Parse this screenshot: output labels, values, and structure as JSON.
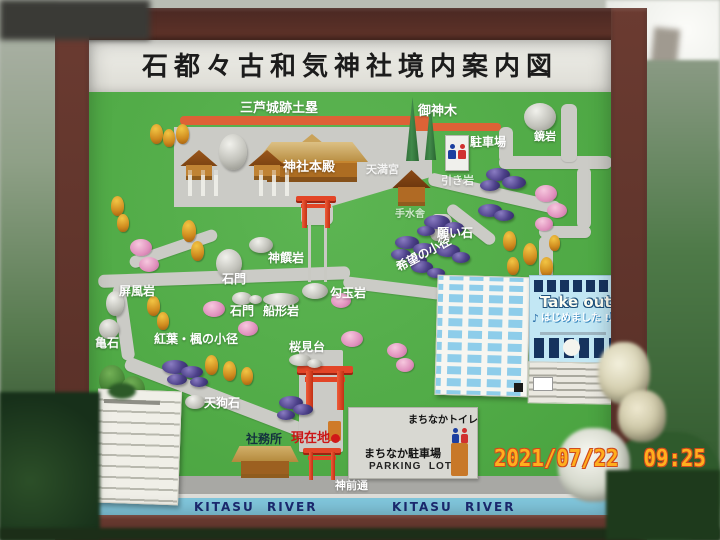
{
  "photo": {
    "timestamp": "2021/07/22  09:25"
  },
  "board": {
    "title": "石都々古和気神社境内案内図",
    "map": {
      "labels": {
        "dorui": "三芦城跡土塁",
        "goshinboku": "御神木",
        "parking": "駐車場",
        "kagamiiwa": "鏡岩",
        "honden": "神社本殿",
        "tenmangu": "天満宮",
        "hikiiwa": "引き岩",
        "temizuya": "手水舎",
        "negaiishi": "願い石",
        "kibou_no_komichi": "希望の小径",
        "shinseniwa": "神饌岩",
        "sekimon_upper": "石門",
        "sekimon_lower": "石門",
        "magatamaiwa": "勾玉岩",
        "funagataiwa": "船形岩",
        "byobuiwa": "屏風岩",
        "kameishi": "亀石",
        "momiji_no_komichi": "紅葉・楓の小径",
        "sakuramidai": "桜見台",
        "tenguseki": "天狗石",
        "shamusho": "社務所",
        "genzaichi": "現在地",
        "shinzendori": "神前通",
        "river_left": "KITASU  RIVER",
        "river_right": "KITASU  RIVER"
      },
      "facility_box": {
        "toilet_label": "まちなかトイレ",
        "parking_label": "まちなか駐車場",
        "parking_en": "PARKING  LOT"
      },
      "posters": {
        "takeout_title": "Take out",
        "takeout_sub": "はじめました !!",
        "note": "♪"
      }
    }
  },
  "colors": {
    "frame_brown": "#5d332c",
    "map_green": "#51ab47",
    "torii_red": "#e34527",
    "river_blue": "#82c8de",
    "genzaichi_red": "#cc1616",
    "timestamp_orange": "#ffaf1e"
  }
}
